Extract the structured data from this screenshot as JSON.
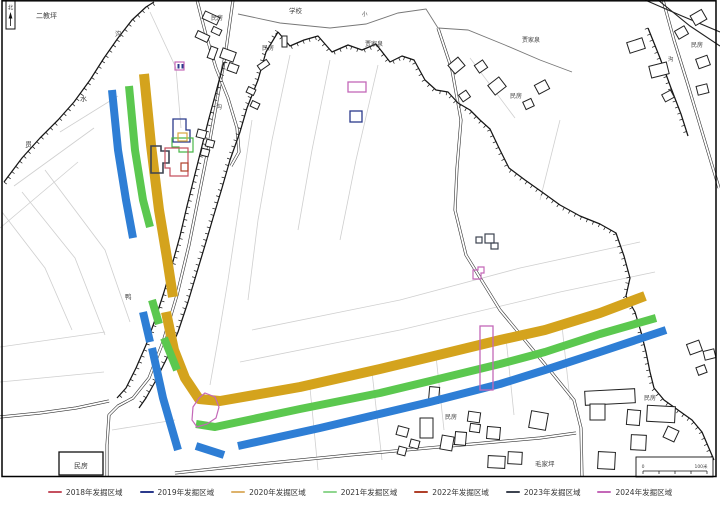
{
  "legend": {
    "items": [
      {
        "year": "2018",
        "label": "2018年发掘区域",
        "color": "#c5505f"
      },
      {
        "year": "2019",
        "label": "2019年发掘区域",
        "color": "#2b3a8c"
      },
      {
        "year": "2020",
        "label": "2020年发掘区域",
        "color": "#ddb26b"
      },
      {
        "year": "2021",
        "label": "2021年发掘区域",
        "color": "#8fd68f"
      },
      {
        "year": "2022",
        "label": "2022年发掘区域",
        "color": "#b0402a"
      },
      {
        "year": "2023",
        "label": "2023年发掘区域",
        "color": "#3d4350"
      },
      {
        "year": "2024",
        "label": "2024年发掘区域",
        "color": "#c468b8"
      }
    ]
  },
  "map": {
    "band_colors": {
      "b2019": "#2e7ed5",
      "b2020": "#d4a31d",
      "b2021": "#5bc84f"
    },
    "marker_colors": {
      "c2018": "#c5505f",
      "c2019": "#2b3a8c",
      "c2020": "#d8a73f",
      "c2021": "#49b849",
      "c2022": "#b0402a",
      "c2023": "#3d4350",
      "c2024": "#c468b8"
    },
    "labels": [
      {
        "text": "二教坪",
        "x": 36,
        "y": 18,
        "size": 7
      },
      {
        "text": "沟",
        "x": 115,
        "y": 36,
        "size": 6.5
      },
      {
        "text": "民房",
        "x": 211,
        "y": 20,
        "size": 6
      },
      {
        "text": "学校",
        "x": 289,
        "y": 13,
        "size": 6.5
      },
      {
        "text": "小",
        "x": 362,
        "y": 16,
        "size": 5.5
      },
      {
        "text": "贾家泉",
        "x": 365,
        "y": 46,
        "size": 6
      },
      {
        "text": "民房",
        "x": 262,
        "y": 50,
        "size": 6
      },
      {
        "text": "贾家泉",
        "x": 522,
        "y": 42,
        "size": 6
      },
      {
        "text": "民房",
        "x": 691,
        "y": 47,
        "size": 6
      },
      {
        "text": "民房",
        "x": 510,
        "y": 98,
        "size": 6
      },
      {
        "text": "沟",
        "x": 668,
        "y": 61,
        "size": 5.5
      },
      {
        "text": "沟",
        "x": 216,
        "y": 109,
        "size": 6
      },
      {
        "text": "水",
        "x": 80,
        "y": 101,
        "size": 7
      },
      {
        "text": "贯",
        "x": 25,
        "y": 147,
        "size": 7
      },
      {
        "text": "鸭",
        "x": 125,
        "y": 299,
        "size": 6.5
      },
      {
        "text": "民房",
        "x": 445,
        "y": 419,
        "size": 6
      },
      {
        "text": "民房",
        "x": 644,
        "y": 400,
        "size": 6
      },
      {
        "text": "毛家坪",
        "x": 535,
        "y": 466,
        "size": 6.5
      },
      {
        "text": "民房",
        "x": 81,
        "y": 468,
        "size": 7,
        "anchor": "middle"
      },
      {
        "text": "北",
        "x": 10.5,
        "y": 9.5,
        "size": 5.5,
        "anchor": "middle"
      },
      {
        "text": "0",
        "x": 643,
        "y": 468,
        "size": 4.5,
        "anchor": "middle"
      },
      {
        "text": "100米",
        "x": 701,
        "y": 468,
        "size": 4.5,
        "anchor": "middle"
      }
    ]
  }
}
